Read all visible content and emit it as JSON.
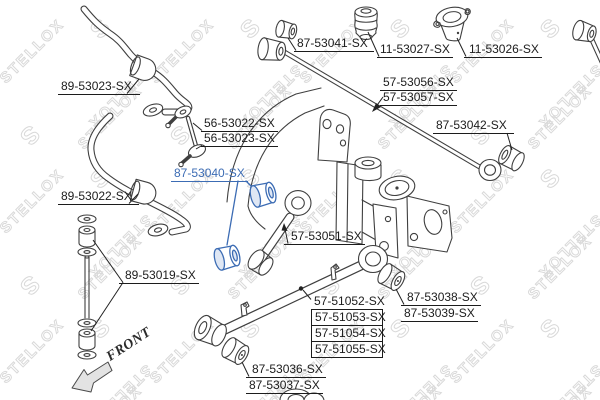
{
  "diagram": {
    "watermark_text": "STELLOX",
    "watermark_initial": "S",
    "front_label": "FRONT",
    "highlighted_part": "87-53040-SX",
    "colors": {
      "background": "#ffffff",
      "line_art": "#3f3f3f",
      "label_text": "#1c1c1c",
      "highlight_blue": "#3c6cb4",
      "watermark_gray": "#d9d9d9"
    },
    "labels": {
      "p87_53041": "87-53041-SX",
      "p11_53027": "11-53027-SX",
      "p11_53026": "11-53026-SX",
      "p89_53023": "89-53023-SX",
      "p57_53056": "57-53056-SX",
      "p57_53057": "57-53057-SX",
      "p87_53042": "87-53042-SX",
      "p56_53022": "56-53022-SX",
      "p56_53023": "56-53023-SX",
      "p87_53040": "87-53040-SX",
      "p89_53022": "89-53022-SX",
      "p57_53051": "57-53051-SX",
      "p89_53019": "89-53019-SX",
      "p57_51052": "57-51052-SX",
      "p57_51053": "57-51053-SX",
      "p57_51054": "57-51054-SX",
      "p57_51055": "57-51055-SX",
      "p87_53038": "87-53038-SX",
      "p87_53039": "87-53039-SX",
      "p87_53036": "87-53036-SX",
      "p87_53037": "87-53037-SX"
    }
  }
}
